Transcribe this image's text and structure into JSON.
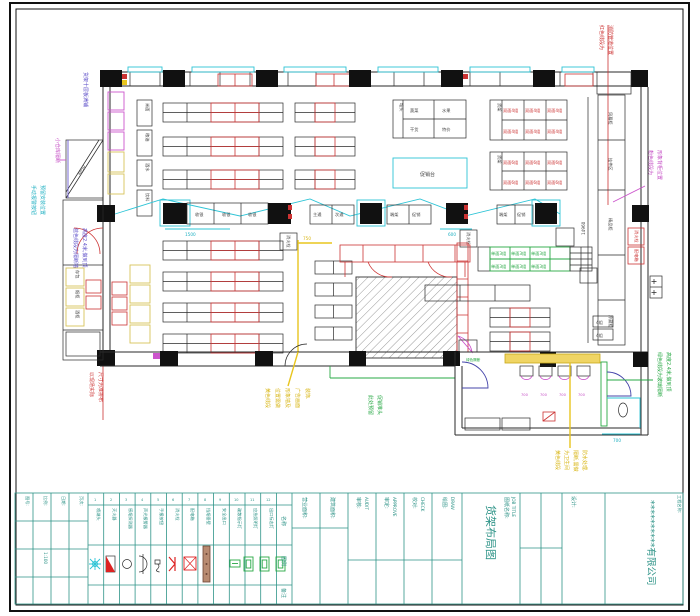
{
  "doc": {
    "type": "CAD shelf layout drawing",
    "sheet_bg": "#ffffff"
  },
  "ann": {
    "topRightRed": [
      "红色线段为",
      "消防管道位置"
    ],
    "rightMagenta": [
      "粉色线段为",
      "形象背柜位置"
    ],
    "leftBlue": [
      "货架十层板满铺"
    ],
    "leftMagenta": [
      "小仓库隔断"
    ],
    "leftCyan": [
      "手动报警按钮",
      "预留安装位置"
    ],
    "leftPurple": [
      "蓝色线段为隔断墙",
      "高度2.4米,做到顶"
    ],
    "bottomLeftRed": [
      "以现场实际",
      "尺寸为准排布"
    ],
    "midYellow": [
      "黄色线段",
      "位置需做",
      "形象墙及",
      "广告画面",
      "装饰."
    ],
    "midGreen": [
      "此处预留",
      "促销堆头"
    ],
    "annexYellow": [
      "黄色线段",
      "为卫生间",
      "隔断,需做",
      "防水处理."
    ],
    "annexGreen": [
      "绿色线段为玻璃隔断",
      "高度2.4米,做到顶"
    ],
    "annexGreenSmall": "绿色隔断"
  },
  "dims": {
    "checkoutLeft": "1500",
    "checkoutRight": "600",
    "toilet": "700",
    "rightWall": "14960",
    "ramp": "4850",
    "yellowTop": "750",
    "fixture": "700"
  },
  "labels": {
    "leftBoxes": [
      "米面",
      "粮油",
      "酒水",
      "饮料"
    ],
    "stackBoxes": [
      "存包",
      "烟柜",
      "酒柜"
    ],
    "checkoutG1": [
      "收银",
      "收银",
      "收银"
    ],
    "checkoutG2": [
      "主通",
      "次通"
    ],
    "checkoutG3": [
      "端架",
      "促销"
    ],
    "checkoutG4": [
      "端架",
      "促销"
    ],
    "corridor": [
      "风幕柜",
      "挂件区",
      "精品柜",
      "冷藏柜"
    ],
    "corridorBoxes": [
      "4组",
      "4组"
    ],
    "rightRedBoxes": [
      "消火栓",
      "配电箱"
    ],
    "island": "促销台",
    "hydrant": "消火栓"
  },
  "tables": {
    "t1": {
      "header": "堆头",
      "cells": [
        "蔬菜",
        "水果",
        "干货",
        "特价"
      ]
    },
    "t2": {
      "header": "货架",
      "cells": [
        "双面4组",
        "双面4组",
        "双面4组",
        "双面4组",
        "双面4组",
        "双面4组"
      ]
    },
    "t3": {
      "header": "货架",
      "cells": [
        "双面6组",
        "双面6组",
        "双面6组",
        "双面6组",
        "双面6组",
        "双面6组"
      ]
    },
    "green": {
      "cells": [
        "单面3组",
        "单面3组",
        "单面3组",
        "单面3组",
        "单面3组",
        "单面3组"
      ]
    }
  },
  "legend": {
    "rowLabels": [
      "名称",
      "图例",
      "备注"
    ],
    "items": [
      {
        "no": "1",
        "name": "喷淋头"
      },
      {
        "no": "2",
        "name": "灭火器"
      },
      {
        "no": "3",
        "name": "感烟探测器"
      },
      {
        "no": "4",
        "name": "声光报警器"
      },
      {
        "no": "5",
        "name": "手报按钮"
      },
      {
        "no": "6",
        "name": "消火栓"
      },
      {
        "no": "7",
        "name": "配电箱"
      },
      {
        "no": "8",
        "name": "挡烟垂壁"
      },
      {
        "no": "9",
        "name": "安全出口"
      },
      {
        "no": "10",
        "name": "疏散指示灯"
      },
      {
        "no": "11",
        "name": "应急照明灯"
      },
      {
        "no": "12",
        "name": "出口标志灯"
      }
    ]
  },
  "tb": {
    "minis": [
      {
        "label": "图号:",
        "value": ""
      },
      {
        "label": "比例:",
        "value": "1:100"
      },
      {
        "label": "日期:",
        "value": ""
      },
      {
        "label": "页次:",
        "value": ""
      }
    ],
    "fields": [
      {
        "label": "营业面积:",
        "sub": ""
      },
      {
        "label": "建筑面积:",
        "sub": ""
      },
      {
        "label": "审核:",
        "sub": "AUDIT"
      },
      {
        "label": "审定:",
        "sub": "APPROVE"
      },
      {
        "label": "校对:",
        "sub": "CHECK"
      },
      {
        "label": "绘图:",
        "sub": "DRAW"
      }
    ],
    "jobTitleLabel": "图纸名称:",
    "jobTitleEn": "JOB TITLE",
    "drawingName": "货架布局图",
    "designLabel": "设计:",
    "projectLabel": "工程名称:",
    "company": "**********有限公司"
  }
}
